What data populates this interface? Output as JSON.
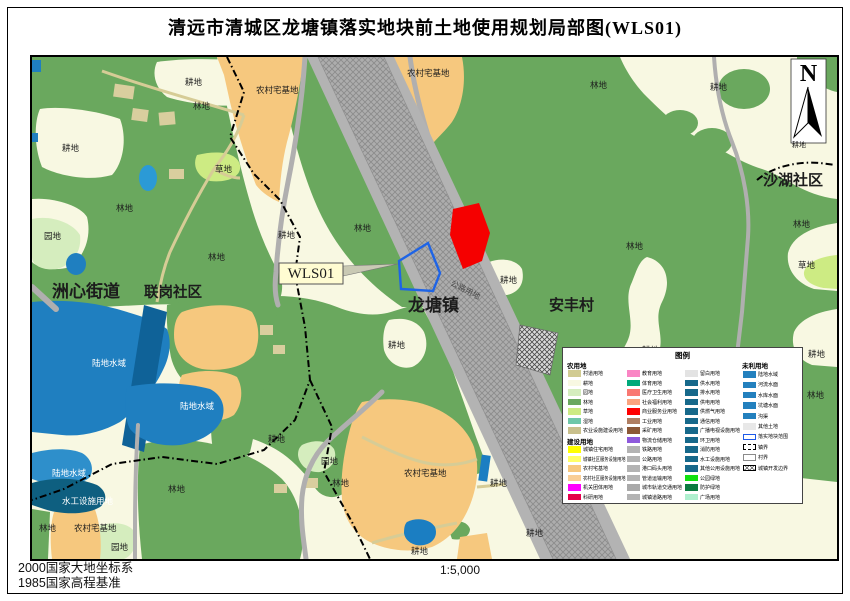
{
  "title": "清远市清城区龙塘镇落实地块前土地使用规划局部图(WLS01)",
  "footer": {
    "datum_line1": "2000国家大地坐标系",
    "datum_line2": "1985国家高程基准",
    "scale": "1:5,000"
  },
  "north": {
    "label": "N"
  },
  "parcel": {
    "code_label": "WLS01"
  },
  "colors": {
    "cropland": "#F8F8E2",
    "forest": "#6AA85E",
    "orchard": "#D5EDBE",
    "grass": "#CDEB83",
    "village": "#F6C87E",
    "water": "#1F7FC0",
    "water_dark": "#0F6298",
    "pond": "#2B9AD6",
    "hydraulic": "#0E5F80",
    "road_gray": "#B0AFAF",
    "rail_band": "#ADADAD",
    "parcel_red": "#F50000",
    "parcel_blue_outline": "#1E64E6"
  },
  "map": {
    "labels": [
      {
        "t": "洲心街道",
        "x": 20,
        "y": 240,
        "c": "b17"
      },
      {
        "t": "联岗社区",
        "x": 112,
        "y": 240,
        "c": "b14"
      },
      {
        "t": "龙塘镇",
        "x": 376,
        "y": 254,
        "c": "b17"
      },
      {
        "t": "安丰村",
        "x": 517,
        "y": 253,
        "c": "b15"
      },
      {
        "t": "沙湖社区",
        "x": 731,
        "y": 128,
        "c": "b15"
      },
      {
        "t": "WLS01",
        "x": 279,
        "y": 221,
        "c": "wls"
      },
      {
        "t": "公路用地",
        "x": 418,
        "y": 228,
        "c": "road"
      },
      {
        "t": "耕地",
        "x": 153,
        "y": 28,
        "c": "sm"
      },
      {
        "t": "林地",
        "x": 161,
        "y": 52,
        "c": "sm"
      },
      {
        "t": "农村宅基地",
        "x": 224,
        "y": 36,
        "c": "sm"
      },
      {
        "t": "农村宅基地",
        "x": 375,
        "y": 19,
        "c": "sm"
      },
      {
        "t": "林地",
        "x": 558,
        "y": 31,
        "c": "sm"
      },
      {
        "t": "耕地",
        "x": 678,
        "y": 33,
        "c": "sm"
      },
      {
        "t": "耕地",
        "x": 760,
        "y": 90,
        "c": "sm7"
      },
      {
        "t": "耕地",
        "x": 30,
        "y": 94,
        "c": "sm"
      },
      {
        "t": "草地",
        "x": 183,
        "y": 115,
        "c": "sm"
      },
      {
        "t": "林地",
        "x": 84,
        "y": 154,
        "c": "sm"
      },
      {
        "t": "园地",
        "x": 12,
        "y": 182,
        "c": "sm"
      },
      {
        "t": "耕地",
        "x": 246,
        "y": 181,
        "c": "sm"
      },
      {
        "t": "林地",
        "x": 176,
        "y": 203,
        "c": "sm"
      },
      {
        "t": "林地",
        "x": 322,
        "y": 174,
        "c": "sm"
      },
      {
        "t": "林地",
        "x": 594,
        "y": 192,
        "c": "sm"
      },
      {
        "t": "耕地",
        "x": 468,
        "y": 226,
        "c": "sm"
      },
      {
        "t": "耕地",
        "x": 356,
        "y": 291,
        "c": "sm"
      },
      {
        "t": "耕地",
        "x": 610,
        "y": 296,
        "c": "sm"
      },
      {
        "t": "林地",
        "x": 626,
        "y": 337,
        "c": "sm"
      },
      {
        "t": "林地",
        "x": 761,
        "y": 170,
        "c": "sm"
      },
      {
        "t": "草地",
        "x": 766,
        "y": 211,
        "c": "sm"
      },
      {
        "t": "耕地",
        "x": 776,
        "y": 300,
        "c": "sm"
      },
      {
        "t": "林地",
        "x": 775,
        "y": 341,
        "c": "sm"
      },
      {
        "t": "耕地",
        "x": 236,
        "y": 385,
        "c": "sm"
      },
      {
        "t": "园地",
        "x": 289,
        "y": 407,
        "c": "sm"
      },
      {
        "t": "林地",
        "x": 300,
        "y": 429,
        "c": "sm"
      },
      {
        "t": "农村宅基地",
        "x": 372,
        "y": 419,
        "c": "sm"
      },
      {
        "t": "耕地",
        "x": 458,
        "y": 429,
        "c": "sm"
      },
      {
        "t": "耕地",
        "x": 494,
        "y": 479,
        "c": "sm"
      },
      {
        "t": "耕地",
        "x": 379,
        "y": 497,
        "c": "sm"
      },
      {
        "t": "林地",
        "x": 136,
        "y": 435,
        "c": "sm"
      },
      {
        "t": "林地",
        "x": 7,
        "y": 474,
        "c": "sm"
      },
      {
        "t": "农村宅基地",
        "x": 42,
        "y": 474,
        "c": "sm"
      },
      {
        "t": "园地",
        "x": 79,
        "y": 493,
        "c": "sm"
      },
      {
        "t": "陆地水域",
        "x": 60,
        "y": 309,
        "c": "wh"
      },
      {
        "t": "陆地水域",
        "x": 148,
        "y": 352,
        "c": "wh"
      },
      {
        "t": "陆地水域",
        "x": 20,
        "y": 419,
        "c": "wh"
      },
      {
        "t": "水工设施用地",
        "x": 30,
        "y": 447,
        "c": "wh"
      }
    ]
  },
  "legend": {
    "title": "图例",
    "columns": [
      {
        "x": 5,
        "start": 12,
        "pitch": 9.5,
        "rows": [
          {
            "h": "农用地"
          },
          {
            "sw": "#D1CB92",
            "t": "村道用地"
          },
          {
            "sw": "#F8F8E2",
            "t": "耕地"
          },
          {
            "sw": "#D5EDBE",
            "t": "园地"
          },
          {
            "sw": "#6AA85E",
            "t": "林地"
          },
          {
            "sw": "#CDEB83",
            "t": "草地"
          },
          {
            "sw": "#6EC7A9",
            "t": "湿地"
          },
          {
            "sw": "#C9C08C",
            "t": "农业设施建设用地"
          },
          {
            "h": "建设用地"
          },
          {
            "sw": "#FFFF00",
            "t": "城镇住宅用地"
          },
          {
            "sw": "#FFFF66",
            "t": "城镇社区服务设施用地"
          },
          {
            "sw": "#F6C87E",
            "t": "农村宅基地"
          },
          {
            "sw": "#F9CE96",
            "t": "农村社区服务设施用地"
          },
          {
            "sw": "#FF00FF",
            "t": "机关团体用地"
          },
          {
            "sw": "#E5004B",
            "t": "科研用地"
          },
          {
            "sw": "#FF8A00",
            "t": "文化用地"
          }
        ]
      },
      {
        "x": 64,
        "start": 21.5,
        "pitch": 9.5,
        "rows": [
          {
            "sw": "#FA85C4",
            "t": "教育用地"
          },
          {
            "sw": "#00A97B",
            "t": "体育用地"
          },
          {
            "sw": "#F97872",
            "t": "医疗卫生用地"
          },
          {
            "sw": "#FBA37E",
            "t": "社会福利用地"
          },
          {
            "sw": "#FF0000",
            "t": "商业服务业用地"
          },
          {
            "sw": "#AF7E62",
            "t": "工业用地"
          },
          {
            "sw": "#8C5837",
            "t": "采矿用地"
          },
          {
            "sw": "#8E59DC",
            "t": "物流仓储用地"
          },
          {
            "sw": "#B3B3B3",
            "t": "铁路用地"
          },
          {
            "sw": "#B3B3B3",
            "t": "公路用地"
          },
          {
            "sw": "#B3B3B3",
            "t": "港口码头用地"
          },
          {
            "sw": "#B3B3B3",
            "t": "管道运输用地"
          },
          {
            "sw": "#A9A9A9",
            "t": "城市轨道交通用地"
          },
          {
            "sw": "#B3B3B3",
            "t": "城镇道路用地"
          },
          {
            "sw": "#B3B3B3",
            "t": "交通场站用地"
          }
        ]
      },
      {
        "x": 122,
        "start": 21.5,
        "pitch": 9.5,
        "rows": [
          {
            "sw": "#E3E3E3",
            "t": "留白用地"
          },
          {
            "sw": "#17698B",
            "t": "供水用地"
          },
          {
            "sw": "#17698B",
            "t": "排水用地"
          },
          {
            "sw": "#17698B",
            "t": "供电用地"
          },
          {
            "sw": "#17698B",
            "t": "供燃气用地"
          },
          {
            "sw": "#17698B",
            "t": "通信用地"
          },
          {
            "sw": "#17698B",
            "t": "广播电视设施用地"
          },
          {
            "sw": "#17698B",
            "t": "环卫用地"
          },
          {
            "sw": "#17698B",
            "t": "消防用地"
          },
          {
            "sw": "#17698B",
            "t": "水工设施用地"
          },
          {
            "sw": "#17698B",
            "t": "其他公用设施用地"
          },
          {
            "sw": "#10E010",
            "t": "公园绿地"
          },
          {
            "sw": "#0B7B40",
            "t": "防护绿地"
          },
          {
            "sw": "#AFF0CF",
            "t": "广场用地"
          },
          {
            "sw": "#8B8B4B",
            "t": "特殊用地"
          }
        ]
      },
      {
        "x": 180,
        "start": 12,
        "pitch": 10.4,
        "rows": [
          {
            "h": "未利用地"
          },
          {
            "sw": "#2380BE",
            "t": "陆地水域"
          },
          {
            "sw": "#2380BE",
            "t": "河流水面"
          },
          {
            "sw": "#2380BE",
            "t": "水库水面"
          },
          {
            "sw": "#2380BE",
            "t": "坑塘水面"
          },
          {
            "sw": "#2380BE",
            "t": "沟渠"
          },
          {
            "sw": "#E8E8E8",
            "t": "其他土地"
          },
          {
            "type": "outline-blue",
            "t": "落实地块范围"
          },
          {
            "type": "dash-black",
            "t": "镇界"
          },
          {
            "type": "outline-gray",
            "t": "村界"
          },
          {
            "type": "hatch",
            "t": "城镇开发边界"
          }
        ]
      }
    ]
  }
}
